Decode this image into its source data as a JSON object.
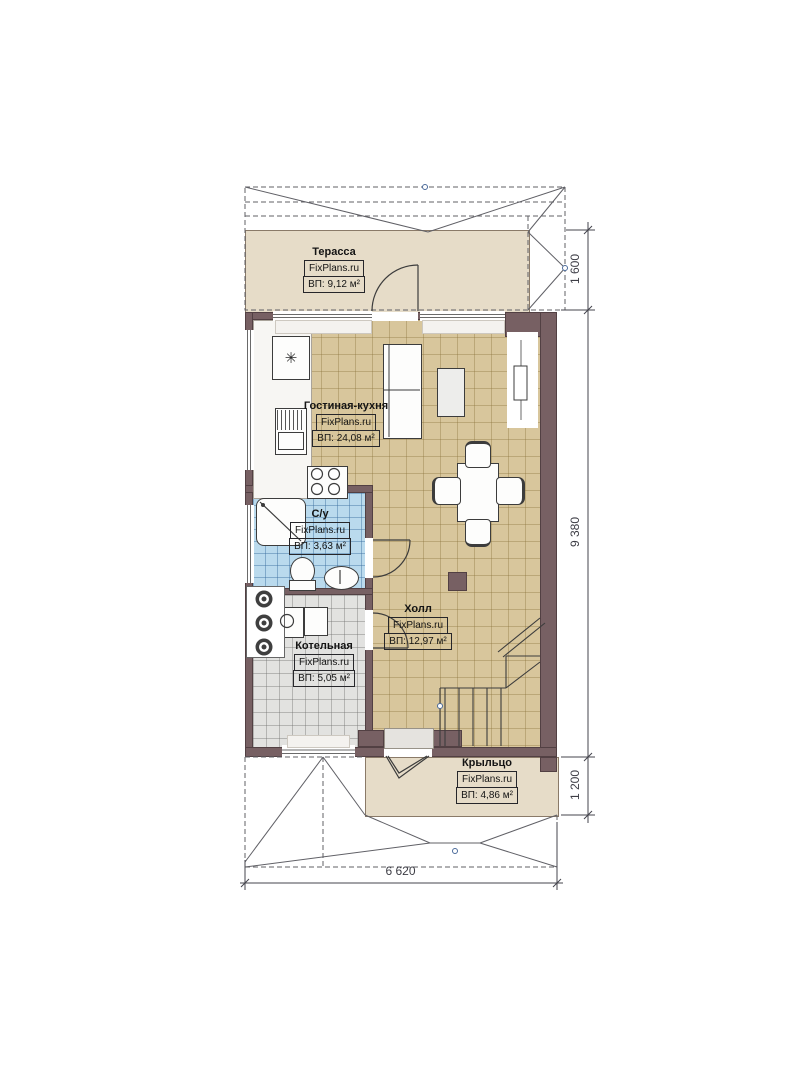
{
  "plan": {
    "rooms": [
      {
        "name": "Терасса",
        "brand": "FixPlans.ru",
        "area": "ВП: 9,12 м²"
      },
      {
        "name": "Гостиная-кухня",
        "brand": "FixPlans.ru",
        "area": "ВП: 24,08 м²"
      },
      {
        "name": "С/у",
        "brand": "FixPlans.ru",
        "area": "ВП: 3,63 м²"
      },
      {
        "name": "Холл",
        "brand": "FixPlans.ru",
        "area": "ВП: 12,97 м²"
      },
      {
        "name": "Котельная",
        "brand": "FixPlans.ru",
        "area": "ВП: 5,05 м²"
      },
      {
        "name": "Крыльцо",
        "brand": "FixPlans.ru",
        "area": "ВП: 4,86 м²"
      }
    ],
    "dimensions": {
      "terrace_depth": "1 600",
      "house_length": "9 380",
      "porch_depth": "1 200",
      "house_width": "6 620"
    },
    "icons": {
      "fridge_snowflake": "✳"
    },
    "colors": {
      "wall": "#776063",
      "floor_tile": "#d8c69c",
      "floor_bathroom": "#badaed",
      "floor_boiler": "#e2e2e0",
      "floor_terrace": "#e6dcc8",
      "linework": "#44444c"
    }
  }
}
